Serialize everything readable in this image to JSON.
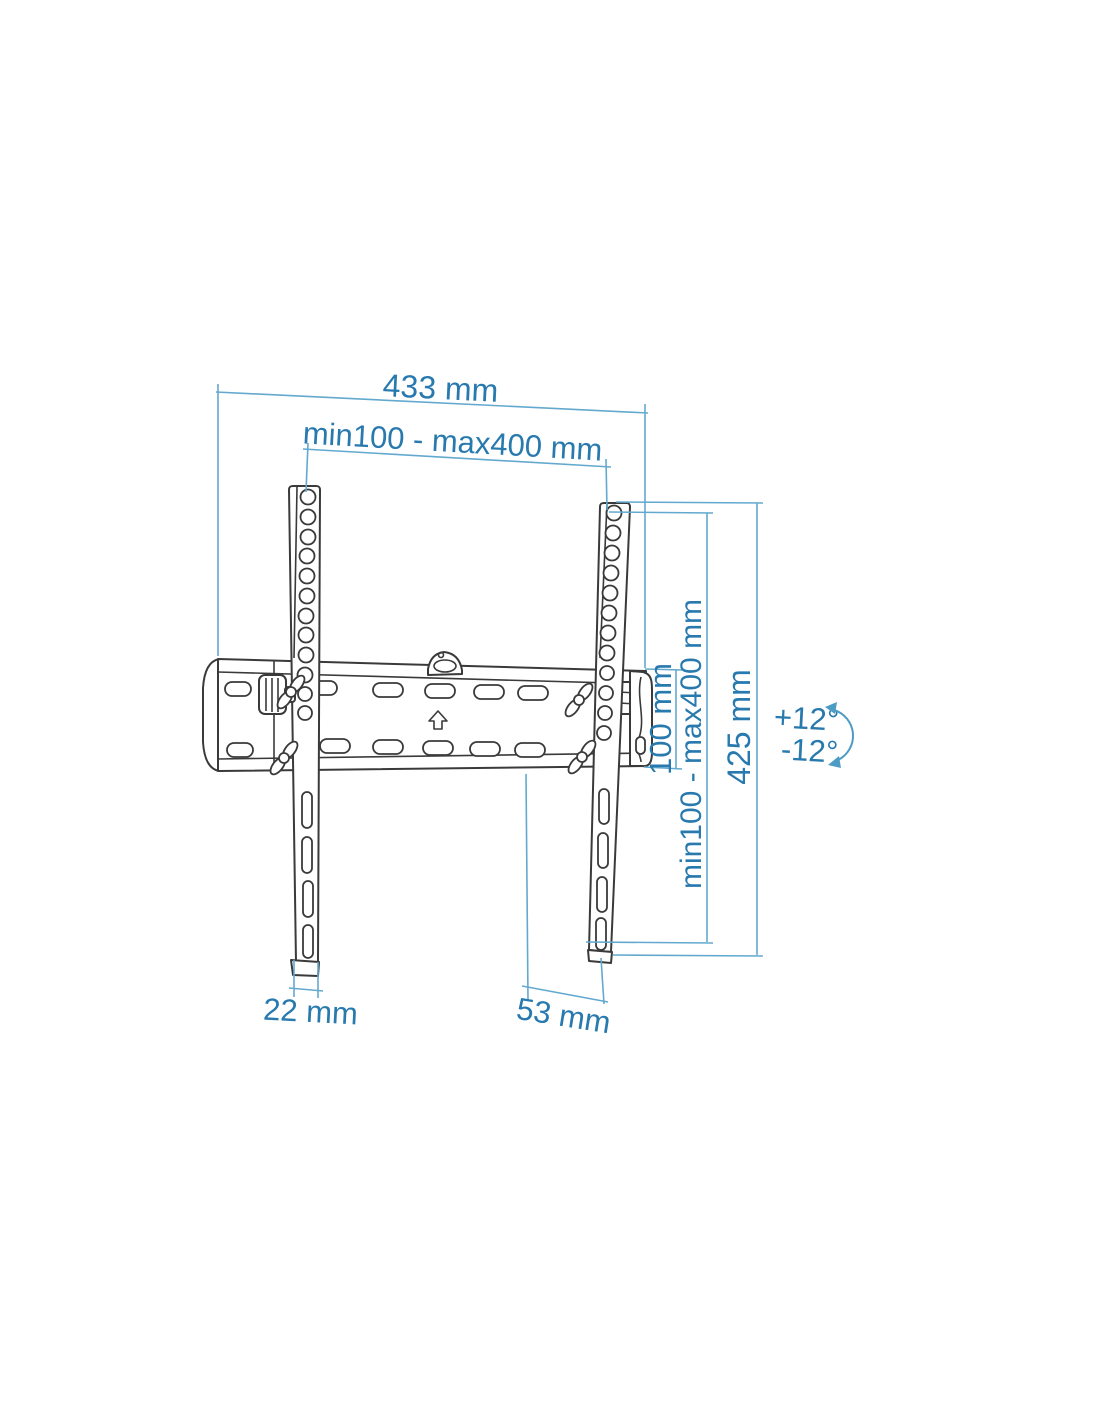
{
  "diagram": {
    "description": "Tilting TV wall mount bracket dimensional line drawing",
    "colors": {
      "dimension_line": "#63a9cf",
      "dimension_text": "#2879ae",
      "drawing_line": "#3a3a3a",
      "background": "#ffffff"
    },
    "dimensions": {
      "total_width": {
        "label": "433 mm"
      },
      "vesa_width": {
        "label": "min100 - max400 mm"
      },
      "plate_height": {
        "label": "100 mm"
      },
      "vesa_height": {
        "label": "min100 - max400 mm"
      },
      "total_height": {
        "label": "425 mm"
      },
      "arm_width": {
        "label": "22 mm"
      },
      "mount_depth": {
        "label": "53 mm"
      },
      "tilt_up": {
        "label": "+12°"
      },
      "tilt_down": {
        "label": "-12°"
      }
    }
  }
}
